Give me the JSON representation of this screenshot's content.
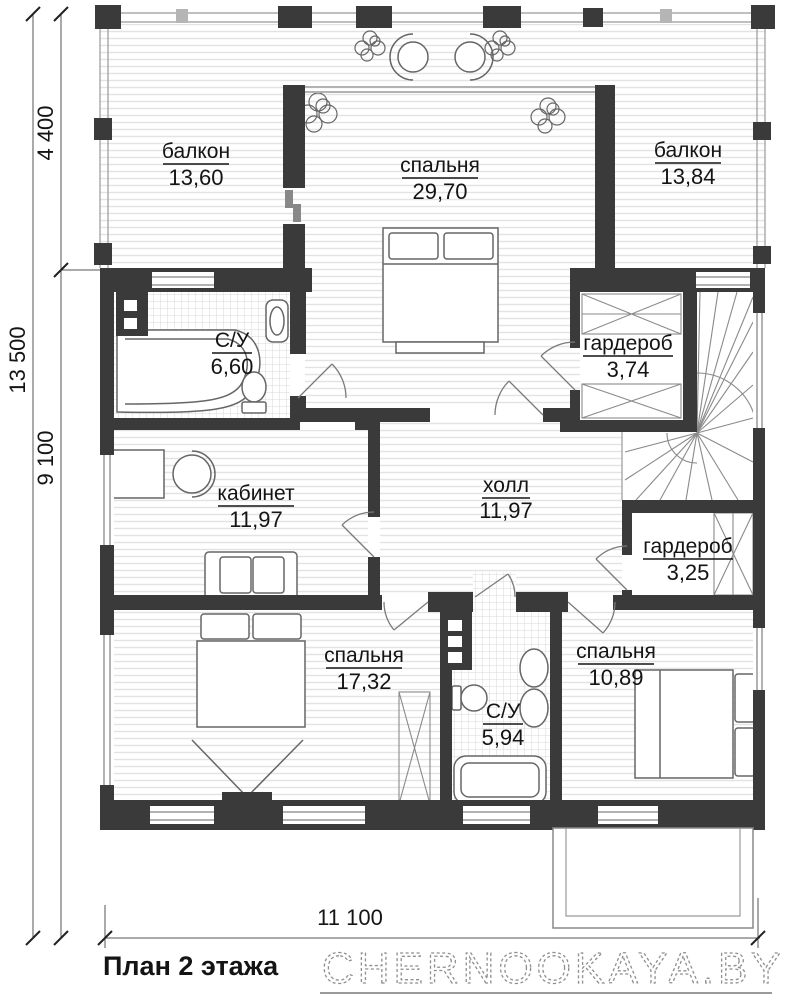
{
  "plan": {
    "title": "План 2 этажа",
    "watermark": "CHERNOOKAYA.BY",
    "rooms": {
      "balcony_left": {
        "name": "балкон",
        "area": "13,60"
      },
      "bedroom_main": {
        "name": "спальня",
        "area": "29,70"
      },
      "balcony_right": {
        "name": "балкон",
        "area": "13,84"
      },
      "bathroom_top": {
        "name": "С/У",
        "area": "6,60"
      },
      "wardrobe_top": {
        "name": "гардероб",
        "area": "3,74"
      },
      "office": {
        "name": "кабинет",
        "area": "11,97"
      },
      "hall": {
        "name": "холл",
        "area": "11,97"
      },
      "wardrobe_bottom": {
        "name": "гардероб",
        "area": "3,25"
      },
      "bedroom_left": {
        "name": "спальня",
        "area": "17,32"
      },
      "bathroom_bottom": {
        "name": "С/У",
        "area": "5,94"
      },
      "bedroom_right": {
        "name": "спальня",
        "area": "10,89"
      }
    },
    "dimensions": {
      "left_total": "13 500",
      "left_top": "4 400",
      "left_bottom": "9 100",
      "bottom": "11 100"
    },
    "colors": {
      "wall": "#3a3a3a",
      "text": "#141414",
      "floor_stripe": "#e3e3e3",
      "watermark": "#8f8f8f"
    }
  }
}
